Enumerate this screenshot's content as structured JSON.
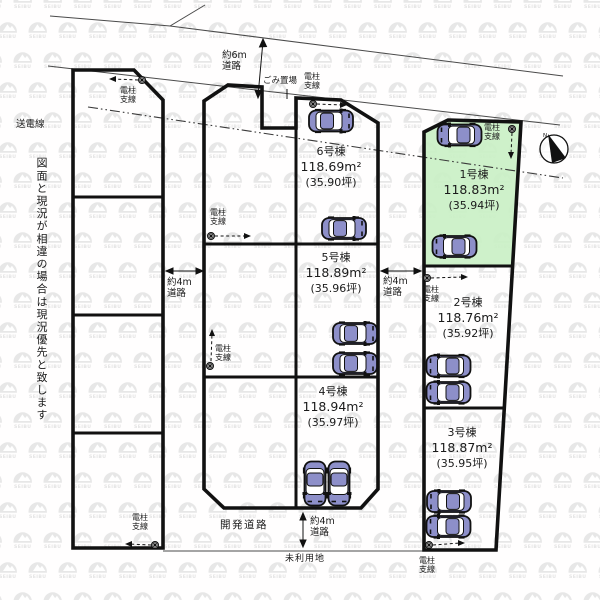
{
  "watermark": "SEIBU",
  "labels": {
    "power_line": "送電線",
    "disclaimer": "図面と現況が相違の場合は現況優先と致します",
    "road_6m": [
      "約6m",
      "道路"
    ],
    "road_4m": [
      "約4m",
      "道路"
    ],
    "garbage": "ごみ置場",
    "pole": [
      "電柱",
      "支線"
    ],
    "dev_road": "開発道路",
    "unused_land": "未利用地",
    "compass_n": "N"
  },
  "lots": [
    {
      "name": "1号棟",
      "area_m2": "118.83m²",
      "area_tsubo": "(35.94坪)",
      "highlighted": true
    },
    {
      "name": "2号棟",
      "area_m2": "118.76m²",
      "area_tsubo": "(35.92坪)",
      "highlighted": false
    },
    {
      "name": "3号棟",
      "area_m2": "118.87m²",
      "area_tsubo": "(35.95坪)",
      "highlighted": false
    },
    {
      "name": "4号棟",
      "area_m2": "118.94m²",
      "area_tsubo": "(35.97坪)",
      "highlighted": false
    },
    {
      "name": "5号棟",
      "area_m2": "118.89m²",
      "area_tsubo": "(35.96坪)",
      "highlighted": false
    },
    {
      "name": "6号棟",
      "area_m2": "118.69m²",
      "area_tsubo": "(35.90坪)",
      "highlighted": false
    }
  ],
  "colors": {
    "highlight_green": "#c9efc4",
    "car_body": "#8d8fc9",
    "line_black": "#1a1a1a",
    "watermark_gray": "#e7e7e7"
  }
}
